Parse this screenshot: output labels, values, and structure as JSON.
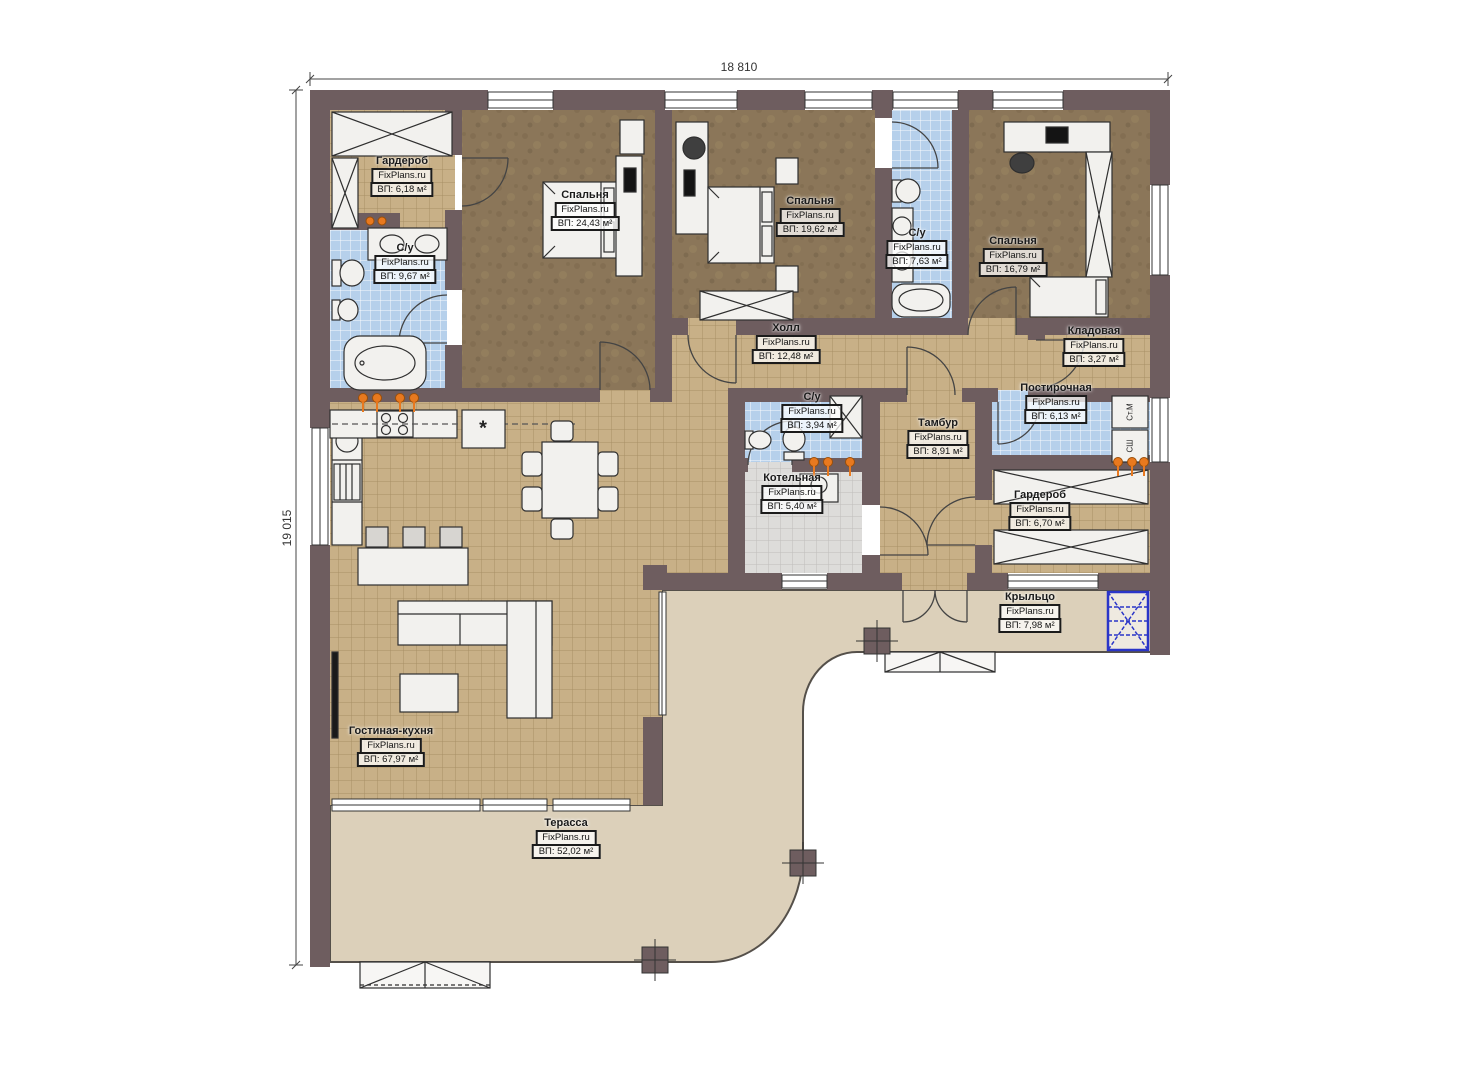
{
  "brand": "FixPlans.ru",
  "dimensions": {
    "width_label": "18 810",
    "height_label": "19 015"
  },
  "rooms": [
    {
      "name": "Гардероб",
      "area": "ВП: 6,18 м²"
    },
    {
      "name": "С/у",
      "area": "ВП: 9,67 м²"
    },
    {
      "name": "Спальня",
      "area": "ВП: 24,43 м²"
    },
    {
      "name": "Спальня",
      "area": "ВП: 19,62 м²"
    },
    {
      "name": "С/у",
      "area": "ВП: 7,63 м²"
    },
    {
      "name": "Спальня",
      "area": "ВП: 16,79 м²"
    },
    {
      "name": "Холл",
      "area": "ВП: 12,48 м²"
    },
    {
      "name": "Кладовая",
      "area": "ВП: 3,27 м²"
    },
    {
      "name": "С/у",
      "area": "ВП: 3,94 м²"
    },
    {
      "name": "Постирочная",
      "area": "ВП: 6,13 м²"
    },
    {
      "name": "Тамбур",
      "area": "ВП: 8,91 м²"
    },
    {
      "name": "Котельная",
      "area": "ВП: 5,40 м²"
    },
    {
      "name": "Гардероб",
      "area": "ВП: 6,70 м²"
    },
    {
      "name": "Крыльцо",
      "area": "ВП: 7,98 м²"
    },
    {
      "name": "Гостиная-кухня",
      "area": "ВП: 67,97 м²"
    },
    {
      "name": "Терасса",
      "area": "ВП: 52,02 м²"
    }
  ],
  "appliances": {
    "washer": "Ст.М",
    "dryer": "СШ"
  },
  "symbols": {
    "fridge": "*"
  },
  "colors": {
    "wall": "#6e5d5f",
    "tan_tile": "#c8b087",
    "blue_tile": "#b6d0eb",
    "gray_tile": "#dddcda",
    "bedroom_floor": "#8b7659",
    "slab": "#dcd0ba",
    "radiator": "#e8791f",
    "grate_blue": "#2a35c8"
  }
}
